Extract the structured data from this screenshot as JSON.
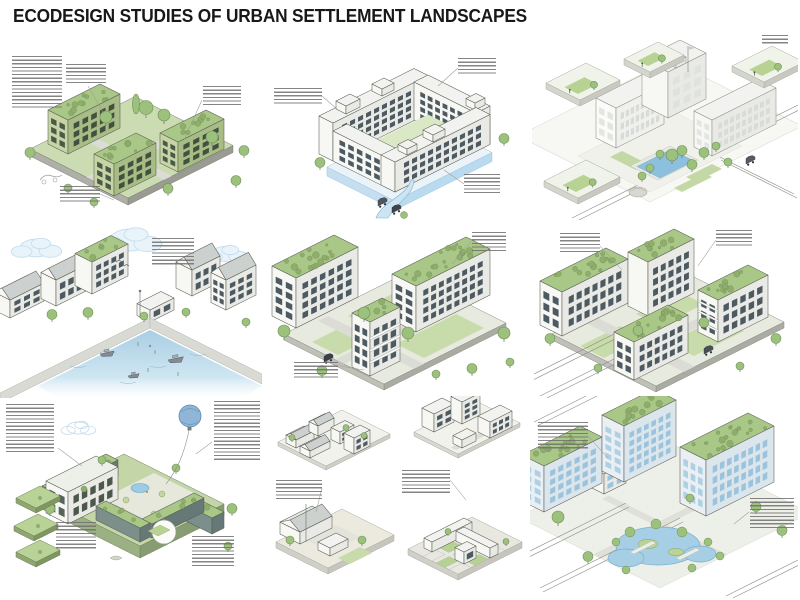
{
  "title": "ECODESIGN STUDIES OF URBAN SETTLEMENT LANDSCAPES",
  "palette": {
    "title_color": "#17181a",
    "annotation_ink": "#6f6f6f",
    "line_ink": "#595c52",
    "lawn_green": "#ccdcb2",
    "roof_green": "#a9c786",
    "tree_green": "#9cc17c",
    "tree_stroke": "#6f8f55",
    "building_white": "#f7f7f4",
    "building_shade": "#e9eae5",
    "building_sage_light": "#c6d4a6",
    "building_sage_dark": "#a8bd85",
    "water_blue": "#a6cfe6",
    "water_stroke": "#7fb2d2",
    "glass_blue": "#9cc3dc",
    "window_dark": "#4e5a62",
    "ground_gray": "#dcdcd6",
    "plinth_gray": "#aeb0a8",
    "leader_gray": "#9b9e97"
  },
  "panels": [
    {
      "id": "green-apartments",
      "annotations": [
        {
          "x": 4,
          "y": 8,
          "w": 50,
          "lines": 15
        },
        {
          "x": 58,
          "y": 16,
          "w": 40,
          "lines": 6
        },
        {
          "x": 195,
          "y": 38,
          "w": 38,
          "lines": 6
        },
        {
          "x": 52,
          "y": 138,
          "w": 40,
          "lines": 5
        }
      ]
    },
    {
      "id": "courtyard-water-garden",
      "annotations": [
        {
          "x": 12,
          "y": 36,
          "w": 48,
          "lines": 5
        },
        {
          "x": 196,
          "y": 6,
          "w": 38,
          "lines": 5
        },
        {
          "x": 202,
          "y": 122,
          "w": 36,
          "lines": 6
        }
      ]
    },
    {
      "id": "campus-plaza-pool",
      "annotations": [
        {
          "x": 230,
          "y": 3,
          "w": 26,
          "lines": 3
        }
      ]
    },
    {
      "id": "harbor-waterfront",
      "annotations": [
        {
          "x": 152,
          "y": 12,
          "w": 42,
          "lines": 8
        }
      ]
    },
    {
      "id": "green-roof-blocks",
      "annotations": [
        {
          "x": 206,
          "y": 6,
          "w": 34,
          "lines": 6
        },
        {
          "x": 28,
          "y": 136,
          "w": 44,
          "lines": 5
        }
      ]
    },
    {
      "id": "intersection-green-roofs",
      "annotations": [
        {
          "x": 26,
          "y": 7,
          "w": 40,
          "lines": 6
        },
        {
          "x": 182,
          "y": 4,
          "w": 36,
          "lines": 5
        }
      ]
    },
    {
      "id": "eco-courtyard",
      "annotations": [
        {
          "x": 0,
          "y": 8,
          "w": 48,
          "lines": 14
        },
        {
          "x": 208,
          "y": 5,
          "w": 46,
          "lines": 17
        },
        {
          "x": 50,
          "y": 126,
          "w": 40,
          "lines": 8
        },
        {
          "x": 186,
          "y": 140,
          "w": 42,
          "lines": 9
        }
      ]
    },
    {
      "id": "typology-studies",
      "annotations": [
        {
          "x": 10,
          "y": 84,
          "w": 46,
          "lines": 6
        },
        {
          "x": 136,
          "y": 74,
          "w": 48,
          "lines": 7
        }
      ]
    },
    {
      "id": "glass-office-campus",
      "annotations": [
        {
          "x": 8,
          "y": 26,
          "w": 50,
          "lines": 8
        },
        {
          "x": 220,
          "y": 102,
          "w": 44,
          "lines": 9
        }
      ]
    }
  ]
}
